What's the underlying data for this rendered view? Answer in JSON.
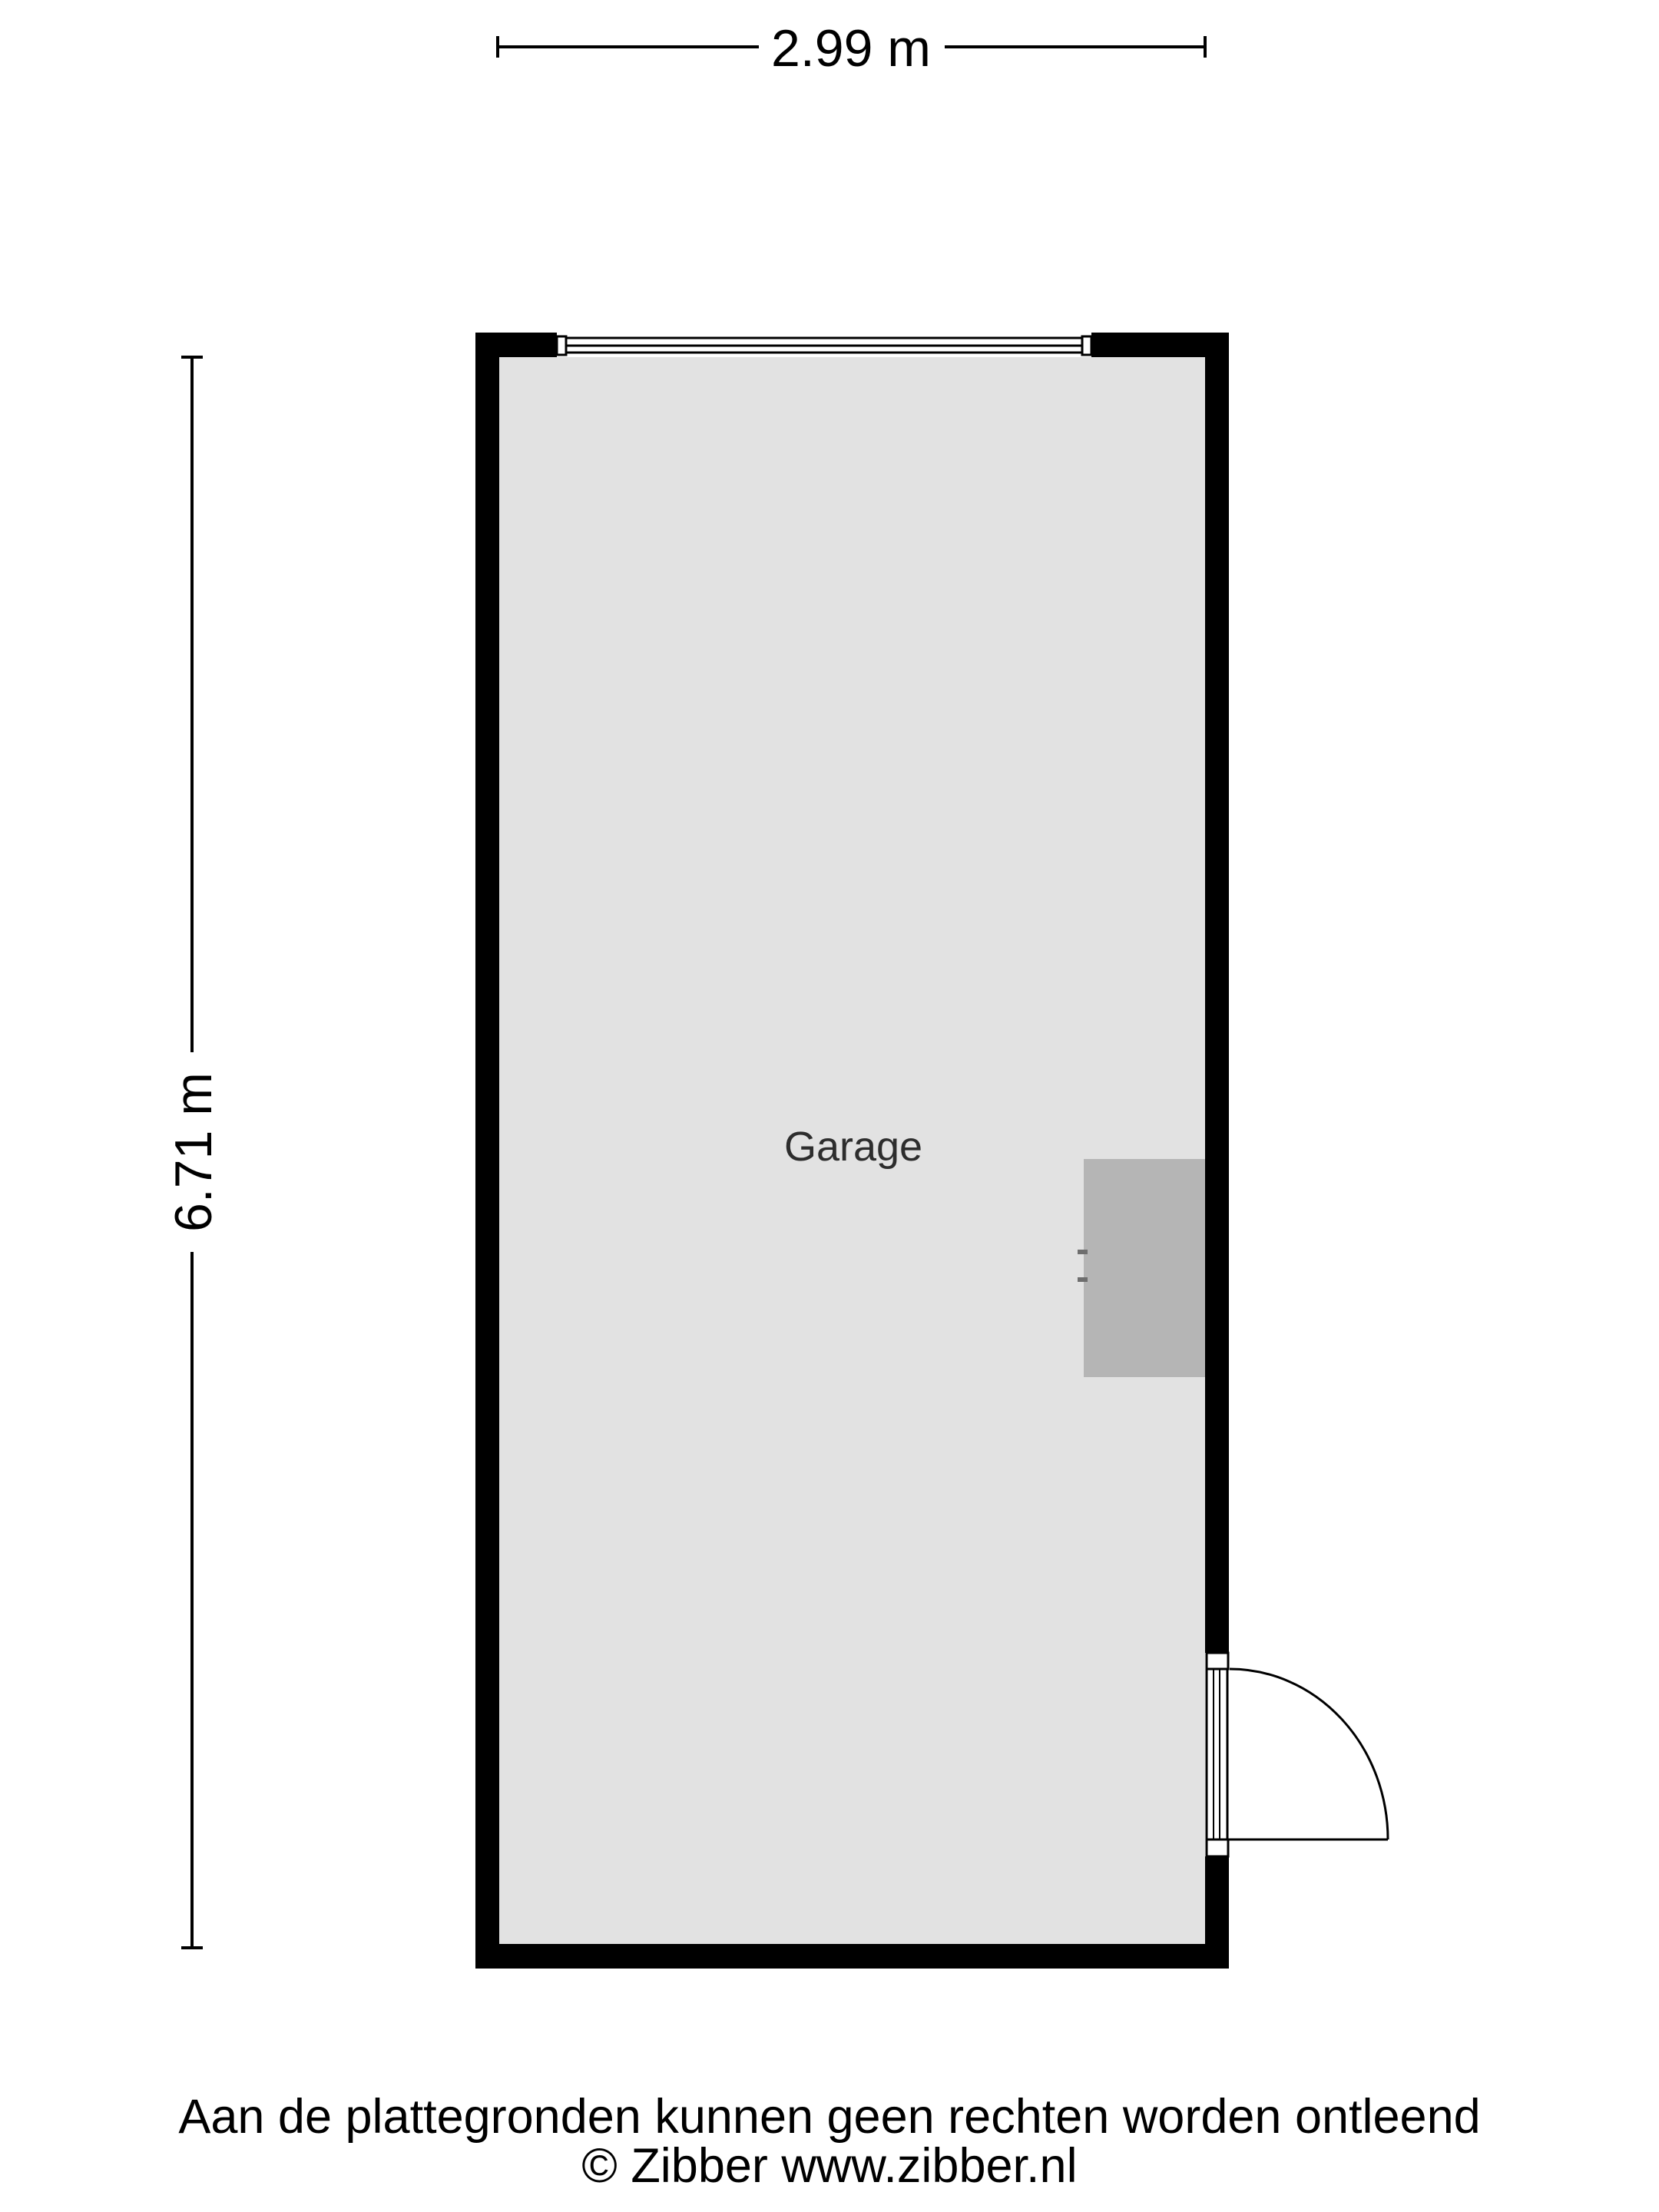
{
  "floorplan": {
    "room": {
      "label": "Garage"
    },
    "dimensions": {
      "width": "2.99 m",
      "height": "6.71 m"
    }
  },
  "footer": {
    "disclaimer": "Aan de plattegronden kunnen geen rechten worden ontleend",
    "copyright": "© Zibber www.zibber.nl"
  },
  "colors": {
    "background": "#ffffff",
    "wall": "#000000",
    "floor": "#e2e2e2",
    "fixture": "#b5b5b5",
    "fixture_marks": "#6e6e6e",
    "dimension_lines": "#000000",
    "room_label_text": "#2d2d2d",
    "footer_text": "#000000"
  }
}
